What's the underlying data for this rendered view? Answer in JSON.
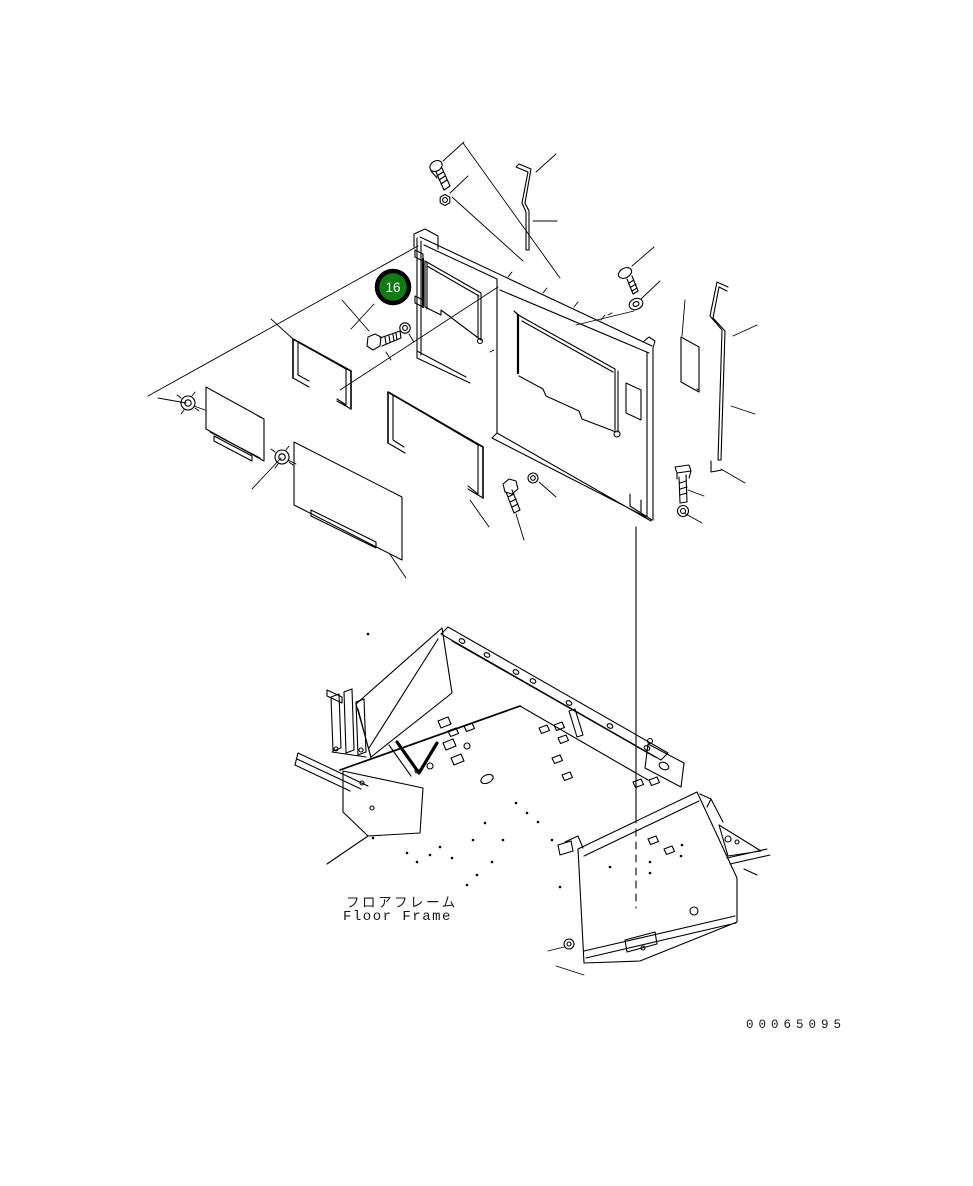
{
  "colors": {
    "background": "#ffffff",
    "line": "#000000",
    "balloon_fill": "#0e7c12",
    "balloon_ring": "#000000",
    "balloon_text": "#ffffff"
  },
  "balloon": {
    "label": "16"
  },
  "captions": {
    "floor_frame_jp": "フロアフレーム",
    "floor_frame_en": "Floor Frame"
  },
  "drawing_number": "00065095"
}
